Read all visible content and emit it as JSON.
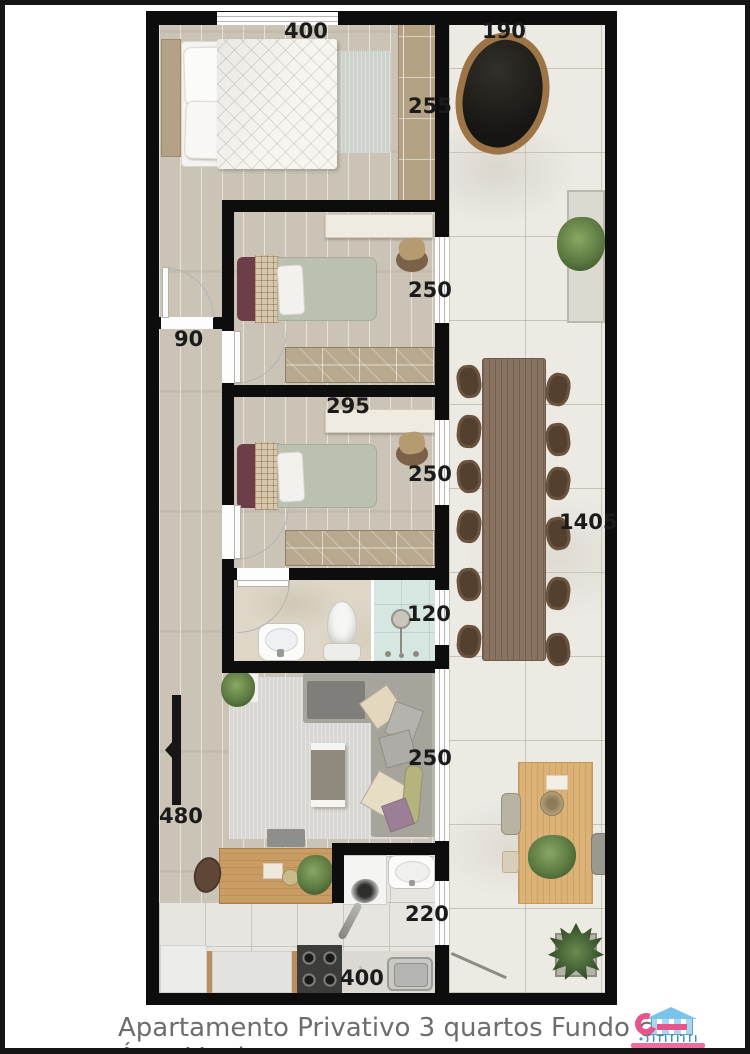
{
  "caption": "Apartamento Privativo 3 quartos Fundo com Área Verde",
  "dimensions": {
    "master_bedroom_width": "400",
    "patio_top_width": "190",
    "master_bedroom_depth": "255",
    "bedroom2_depth": "250",
    "hallway_width": "90",
    "bedroom3_width": "295",
    "bedroom3_depth": "250",
    "patio_length": "1405",
    "bathroom_width": "120",
    "living_room_depth": "250",
    "living_room_width": "480",
    "kitchen_service_width": "220",
    "kitchen_width": "400"
  },
  "colors": {
    "wall": "#0d0d0d",
    "wood_floor": "#cac3b6",
    "stone_floor": "#eceae3",
    "dimension_text": "#1b1b1b",
    "caption_text": "#6d6d6d",
    "logo_blue": "#7cc3ea",
    "logo_pink": "#e8558c"
  }
}
